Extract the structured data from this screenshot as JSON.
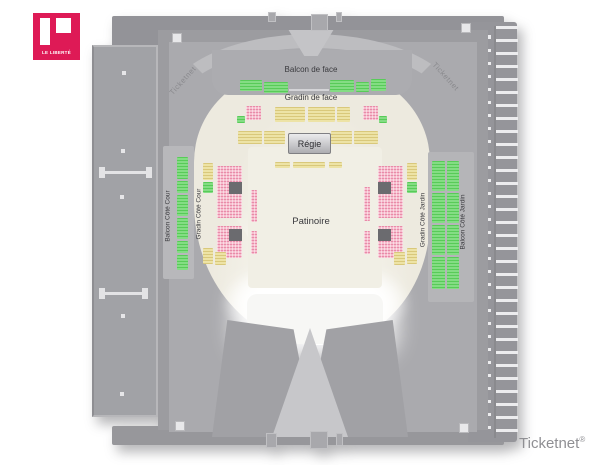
{
  "logo": {
    "text": "LE LIBERTÉ",
    "color": "#DE1A56"
  },
  "brand": {
    "text": "Ticketnet",
    "registered": "®"
  },
  "watermarks": {
    "left": "Ticketnet",
    "right": "Ticketnet"
  },
  "venue": {
    "sections": {
      "balcon_face": "Balcon de face",
      "gradin_face": "Gradin de face",
      "regie": "Régie",
      "patinoire": "Patinoire",
      "balcon_cour": "Balcon Côté Cour",
      "gradin_cour": "Gradin Côté Cour",
      "gradin_jardin": "Gradin Côté Jardin",
      "balcon_jardin": "Balcon Côté Jardin"
    },
    "seat_colors": {
      "green": "#84DC84",
      "pink": "#F6BECD",
      "yellow": "#EDE3A6"
    }
  }
}
